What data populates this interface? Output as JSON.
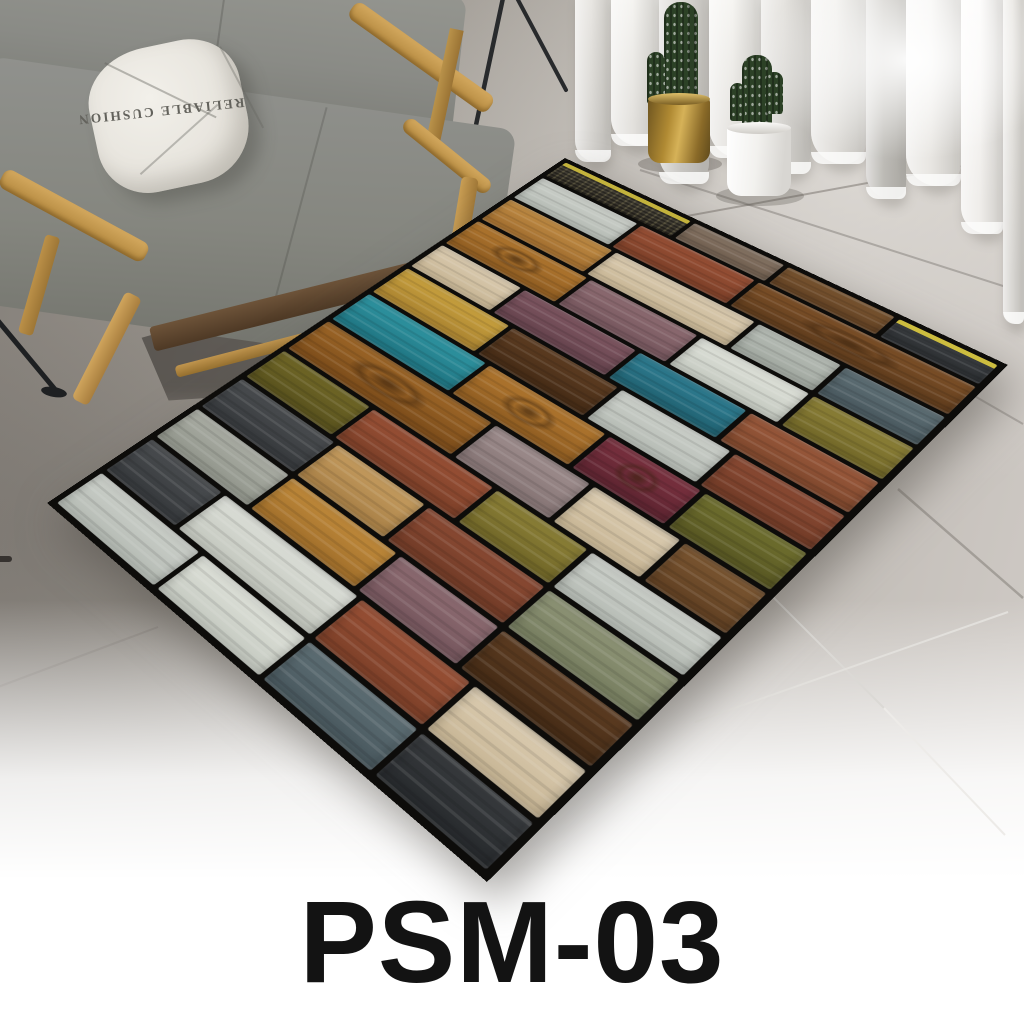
{
  "product": {
    "model": "PSM-03"
  },
  "pillow": {
    "text": "RELIABLE CUSHION"
  },
  "colors": {
    "label_text": "#131313",
    "wall": "#3f464b",
    "floor_dark": "#837e78",
    "floor_light": "#ccc7c2",
    "sofa_fabric": "#8b8c88",
    "wood_frame": "#c59a54",
    "rug_border": "#0d0c0a",
    "curtain_light": "#f8f7f5",
    "cactus_green": "#2c4126",
    "brass_pot": "#b08a33",
    "white_pot": "#f2f1ee"
  },
  "curtain": {
    "folds": [
      [
        36,
        168,
        "#e9e7e3",
        "#d6d4d0",
        "0 0 20px 30px"
      ],
      [
        48,
        152,
        "#f6f5f2",
        "#e3e1dd",
        "0 0 24px 34px"
      ],
      [
        50,
        190,
        "#dcdad6",
        "#c8c6c2",
        "0 0 26px 38px"
      ],
      [
        52,
        164,
        "#f7f6f3",
        "#e5e3df",
        "0 0 22px 32px"
      ],
      [
        50,
        180,
        "#e7e5e1",
        "#d2d0cc",
        "0 0 26px 36px"
      ],
      [
        55,
        170,
        "#f4f3f0",
        "#e0deda",
        "0 0 24px 34px"
      ],
      [
        40,
        205,
        "#d0cec9",
        "#bcbab5",
        "0 0 22px 40px"
      ],
      [
        55,
        192,
        "#f8f7f5",
        "#e8e6e2",
        "0 0 26px 36px"
      ],
      [
        42,
        240,
        "#fdfcfb",
        "#efedea",
        "0 0 24px 44px"
      ],
      [
        21,
        330,
        "#eceae6",
        "#d8d6d2",
        "0 0 10px 20px"
      ]
    ]
  },
  "rug": {
    "rows": [
      {
        "h": 30,
        "p": [
          [
            "mesh",
            34
          ],
          [
            "graybrown",
            22
          ],
          [
            "walnutmid",
            24
          ],
          [
            "blackyellow",
            20
          ]
        ]
      },
      {
        "h": 42,
        "p": [
          [
            "silver",
            26
          ],
          [
            "rustred",
            28
          ],
          [
            "walnutknot",
            46
          ]
        ]
      },
      {
        "h": 42,
        "p": [
          [
            "goldtan",
            28
          ],
          [
            "cream",
            34
          ],
          [
            "silvergray",
            18
          ],
          [
            "slateblue",
            20
          ]
        ]
      },
      {
        "h": 44,
        "p": [
          [
            "goldoak",
            30
          ],
          [
            "mauve",
            26
          ],
          [
            "whiteweather",
            24
          ],
          [
            "olive",
            20
          ]
        ]
      },
      {
        "h": 42,
        "p": [
          [
            "cream",
            22
          ],
          [
            "plum",
            28
          ],
          [
            "tealblue",
            24
          ],
          [
            "rust",
            26
          ]
        ]
      },
      {
        "h": 44,
        "p": [
          [
            "goldyellow",
            28
          ],
          [
            "walnutdark",
            26
          ],
          [
            "silver",
            24
          ],
          [
            "redbrown",
            22
          ]
        ]
      },
      {
        "h": 46,
        "p": [
          [
            "teal",
            32
          ],
          [
            "goldoak",
            28
          ],
          [
            "wine",
            20
          ],
          [
            "olivegreen",
            20
          ]
        ]
      },
      {
        "h": 48,
        "p": [
          [
            "plywood",
            44
          ],
          [
            "graymauve",
            22
          ],
          [
            "cream",
            18
          ],
          [
            "walnutmid",
            16
          ]
        ]
      },
      {
        "h": 44,
        "p": [
          [
            "darkolive",
            24
          ],
          [
            "rustred",
            30
          ],
          [
            "olive",
            20
          ],
          [
            "silver",
            26
          ]
        ]
      },
      {
        "h": 44,
        "p": [
          [
            "charcoal",
            26
          ],
          [
            "tan",
            22
          ],
          [
            "redbrown",
            26
          ],
          [
            "sage",
            26
          ]
        ]
      },
      {
        "h": 44,
        "p": [
          [
            "grayweather",
            26
          ],
          [
            "golden",
            26
          ],
          [
            "mauve",
            22
          ],
          [
            "walnutdark",
            26
          ]
        ]
      },
      {
        "h": 46,
        "p": [
          [
            "charcoal",
            20
          ],
          [
            "whitesilver",
            34
          ],
          [
            "rustred",
            24
          ],
          [
            "cream",
            22
          ]
        ]
      },
      {
        "h": 44,
        "p": [
          [
            "silver",
            28
          ],
          [
            "whiteweather",
            26
          ],
          [
            "slateblue",
            24
          ],
          [
            "charcoaldark",
            22
          ]
        ]
      }
    ],
    "palette": {
      "mesh": {
        "c": [
          "#4a463c",
          "#332f27"
        ],
        "mesh": true,
        "stripe": "#c3b23c"
      },
      "graybrown": {
        "c": [
          "#877565",
          "#6d5c4d"
        ]
      },
      "walnutmid": {
        "c": [
          "#7b5631",
          "#5f3f22"
        ]
      },
      "blackyellow": {
        "c": [
          "#3b3e41",
          "#2b2e31"
        ],
        "stripe": "#cdbd3f"
      },
      "silver": {
        "c": [
          "#ccd0ca",
          "#b4bab3"
        ]
      },
      "rustred": {
        "c": [
          "#9a5136",
          "#7b3f28"
        ]
      },
      "walnutknot": {
        "c": [
          "#7e5128",
          "#5c3a1c"
        ],
        "knot": true
      },
      "goldtan": {
        "c": [
          "#c08c44",
          "#a06c2e"
        ]
      },
      "cream": {
        "c": [
          "#dbccb1",
          "#c6b493"
        ]
      },
      "silvergray": {
        "c": [
          "#b7bdb6",
          "#9fa69e"
        ]
      },
      "slateblue": {
        "c": [
          "#5f7076",
          "#47565c"
        ]
      },
      "goldoak": {
        "c": [
          "#b1772f",
          "#8d5b21"
        ],
        "knot": true
      },
      "mauve": {
        "c": [
          "#8e6c72",
          "#74555c"
        ]
      },
      "whiteweather": {
        "c": [
          "#dfe2da",
          "#c3c8bf"
        ]
      },
      "olive": {
        "c": [
          "#8d8138",
          "#6f6527"
        ]
      },
      "plum": {
        "c": [
          "#7e5661",
          "#64424c"
        ]
      },
      "tealblue": {
        "c": [
          "#2f7e93",
          "#20606f"
        ]
      },
      "rust": {
        "c": [
          "#9c5a3c",
          "#7c462c"
        ]
      },
      "goldyellow": {
        "c": [
          "#c9a23f",
          "#a98230"
        ]
      },
      "walnutdark": {
        "c": [
          "#5e3d22",
          "#432a15"
        ]
      },
      "redbrown": {
        "c": [
          "#8c4b34",
          "#6f3a26"
        ]
      },
      "teal": {
        "c": [
          "#2f95a2",
          "#1f7380"
        ]
      },
      "wine": {
        "c": [
          "#7a313f",
          "#5c2430"
        ],
        "knot": true
      },
      "olivegreen": {
        "c": [
          "#70702f",
          "#565522"
        ]
      },
      "plywood": {
        "c": [
          "#9d6627",
          "#7a4b1a"
        ],
        "knot": true
      },
      "graymauve": {
        "c": [
          "#9e8d8d",
          "#837272"
        ]
      },
      "darkolive": {
        "c": [
          "#716827",
          "#57501d"
        ]
      },
      "charcoal": {
        "c": [
          "#4a4d50",
          "#35383b"
        ]
      },
      "tan": {
        "c": [
          "#c69d60",
          "#a67e45"
        ]
      },
      "sage": {
        "c": [
          "#8f9577",
          "#757c5e"
        ]
      },
      "grayweather": {
        "c": [
          "#abaea5",
          "#90948a"
        ]
      },
      "golden": {
        "c": [
          "#c18b3b",
          "#9f6d2a"
        ]
      },
      "whitesilver": {
        "c": [
          "#dcdfd8",
          "#c2c6bd"
        ]
      },
      "charcoaldark": {
        "c": [
          "#383b3e",
          "#26292c"
        ]
      }
    }
  }
}
